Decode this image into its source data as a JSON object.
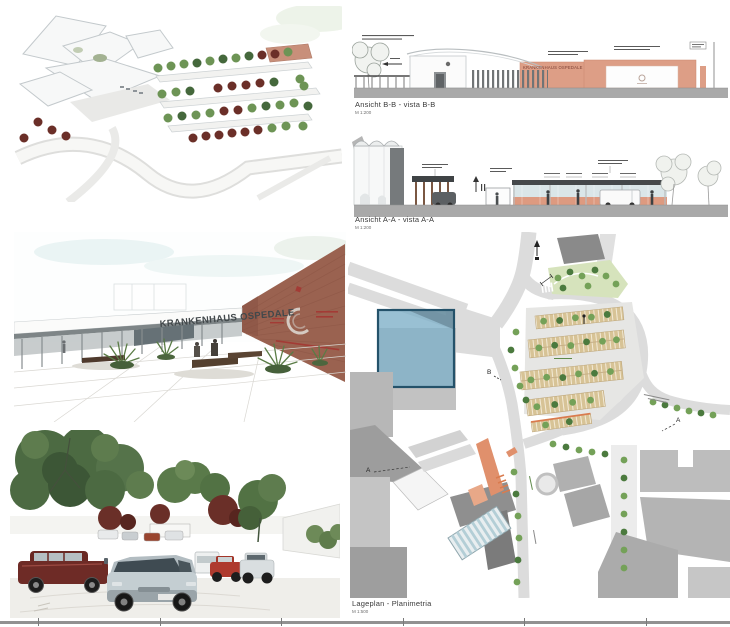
{
  "sheet": {
    "width": 730,
    "height": 627,
    "background": "#ffffff"
  },
  "colors": {
    "elevation_salmon": "#dd9e86",
    "ground_band_gray": "#a9a9a9",
    "road_gray": "#dcdcdc",
    "highlight_blue_fill": "#7fb0c8",
    "highlight_blue_border": "#24526a",
    "plan_accent_orange": "#e0906c",
    "parking_stall_tan": "#d7c396",
    "tree_green": "#74a158",
    "tree_maroon": "#6a2f28",
    "brick_wall": "#9a6250",
    "glass_blue": "#d3e2e4",
    "sign_text": "#42484b"
  },
  "entrance_rendering": {
    "building_sign": "KRANKENHAUS OSPEDALE"
  },
  "elevation_bb": {
    "title": "Ansicht B-B - vista B-B",
    "scale": "M 1:200",
    "building_sign": "KRANKENHAUS OSPEDALE"
  },
  "elevation_aa": {
    "title": "Ansicht A-A - vista A-A",
    "scale": "M 1:200"
  },
  "site_plan": {
    "title": "Lageplan - Planimetria",
    "scale": "M 1:500",
    "section_markers": {
      "b": "B",
      "a_left": "A",
      "a_right": "A"
    }
  }
}
